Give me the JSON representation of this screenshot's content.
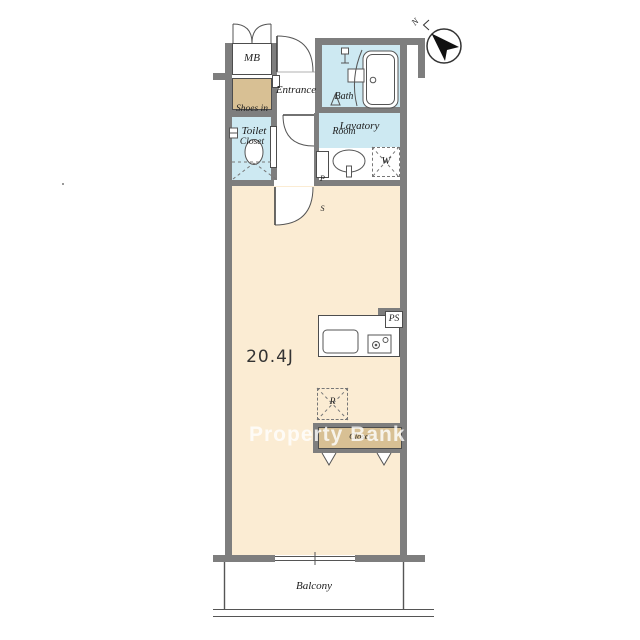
{
  "watermark": {
    "text": "Property Bank",
    "color": "#ffffff"
  },
  "compass": {
    "north_label": "N"
  },
  "rooms": {
    "mb": "MB",
    "shoes_closet_line1": "Shoes in",
    "shoes_closet_line2": "Closet",
    "entrance": "Entrance",
    "bath_line1": "Bath",
    "bath_line2": "Room",
    "toilet": "Toilet",
    "lavatory": "Lavatory",
    "pipe_space_upper_line1": "P",
    "pipe_space_upper_line2": "S",
    "washing_machine": "W",
    "living_area": "20.4J",
    "pipe_space_kitchen": "PS",
    "refrigerator": "R",
    "closet": "Closet",
    "balcony": "Balcony"
  },
  "colors": {
    "floor": "#fbecd3",
    "wet_area": "#cde9f2",
    "closet_fill": "#d8c094",
    "wall": "#7e7e7e",
    "outline": "#555555"
  }
}
